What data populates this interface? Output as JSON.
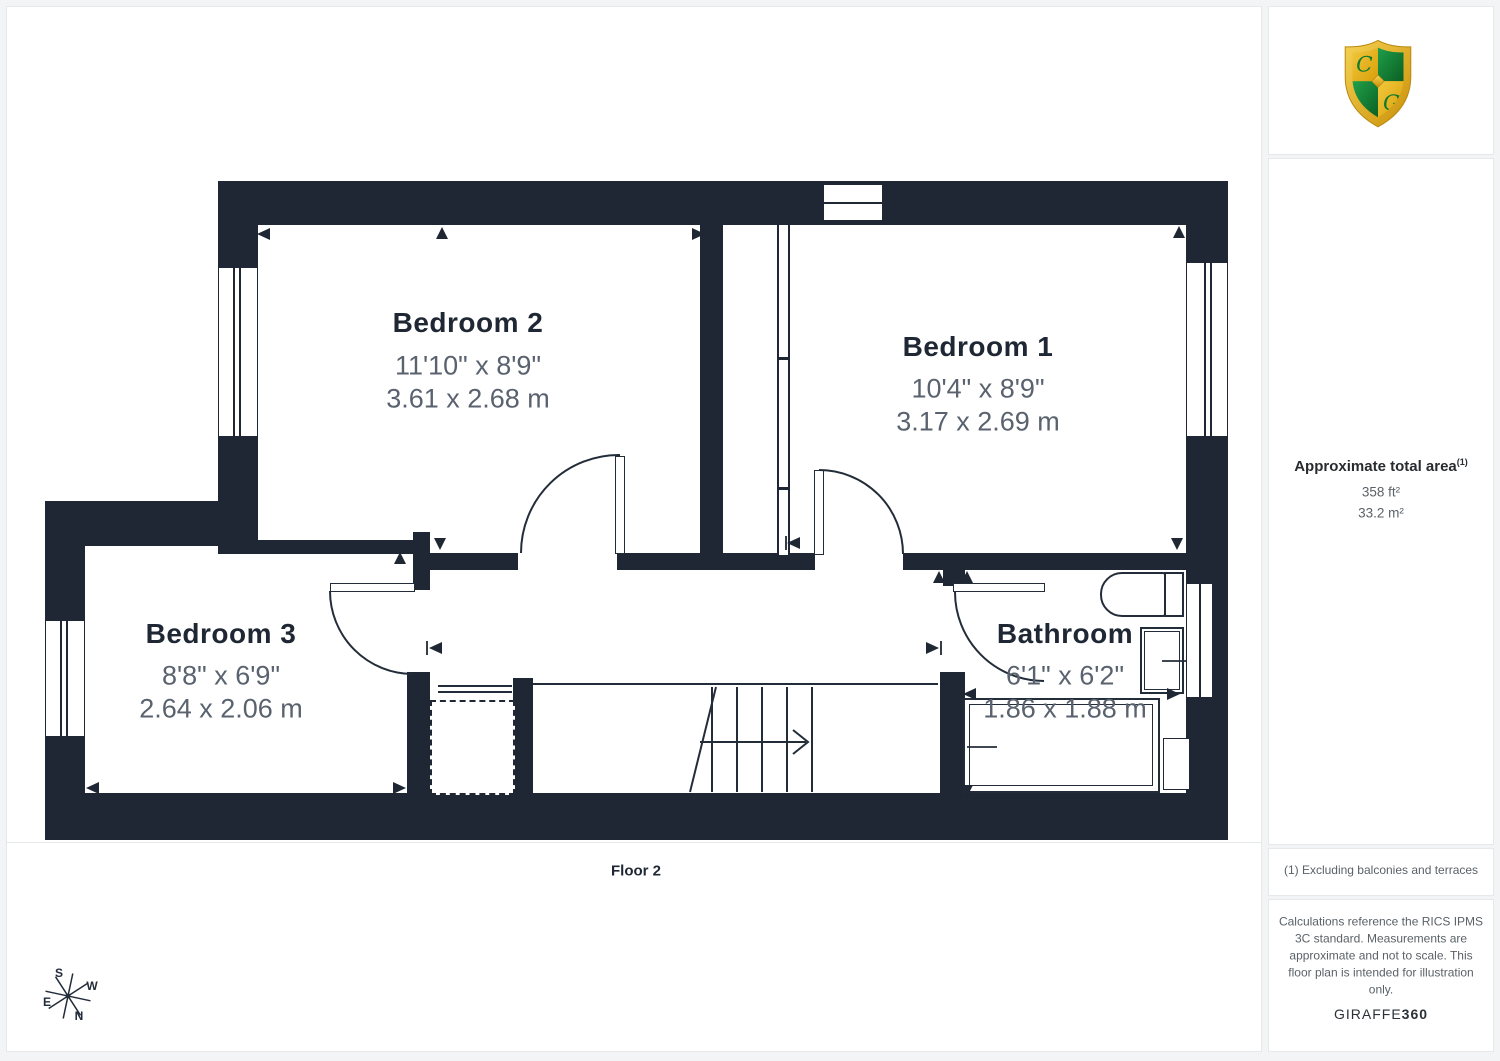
{
  "plan": {
    "floor_label": "Floor 2",
    "rooms": [
      {
        "name": "Bedroom 2",
        "size_imperial": "11'10\" x 8'9\"",
        "size_metric": "3.61 x 2.68 m"
      },
      {
        "name": "Bedroom 1",
        "size_imperial": "10'4\" x 8'9\"",
        "size_metric": "3.17 x 2.69 m"
      },
      {
        "name": "Bedroom 3",
        "size_imperial": "8'8\" x 6'9\"",
        "size_metric": "2.64 x 2.06 m"
      },
      {
        "name": "Bathroom",
        "size_imperial": "6'1\" x 6'2\"",
        "size_metric": "1.86 x 1.88 m"
      }
    ],
    "compass": {
      "north": "N",
      "south": "S",
      "east": "E",
      "west": "W"
    }
  },
  "sidebar": {
    "logo_initials": {
      "top": "C",
      "bottom": "G"
    },
    "area_title": "Approximate total area",
    "area_footnote_marker": "(1)",
    "area_imperial": "358 ft²",
    "area_metric": "33.2 m²",
    "footnote": "(1) Excluding balconies and terraces",
    "disclaimer": "Calculations reference the RICS IPMS 3C standard. Measurements are approximate and not to scale. This floor plan is intended for illustration only.",
    "brand": {
      "name": "GIRAFFE",
      "suffix": "360"
    }
  },
  "colors": {
    "wall": "#1e2733",
    "room_title_text": "#1e2733",
    "dimension_text": "#59626e",
    "panel_border": "#e7e8ea",
    "shield_gold": "#e3ae1c",
    "shield_green": "#14823a"
  }
}
